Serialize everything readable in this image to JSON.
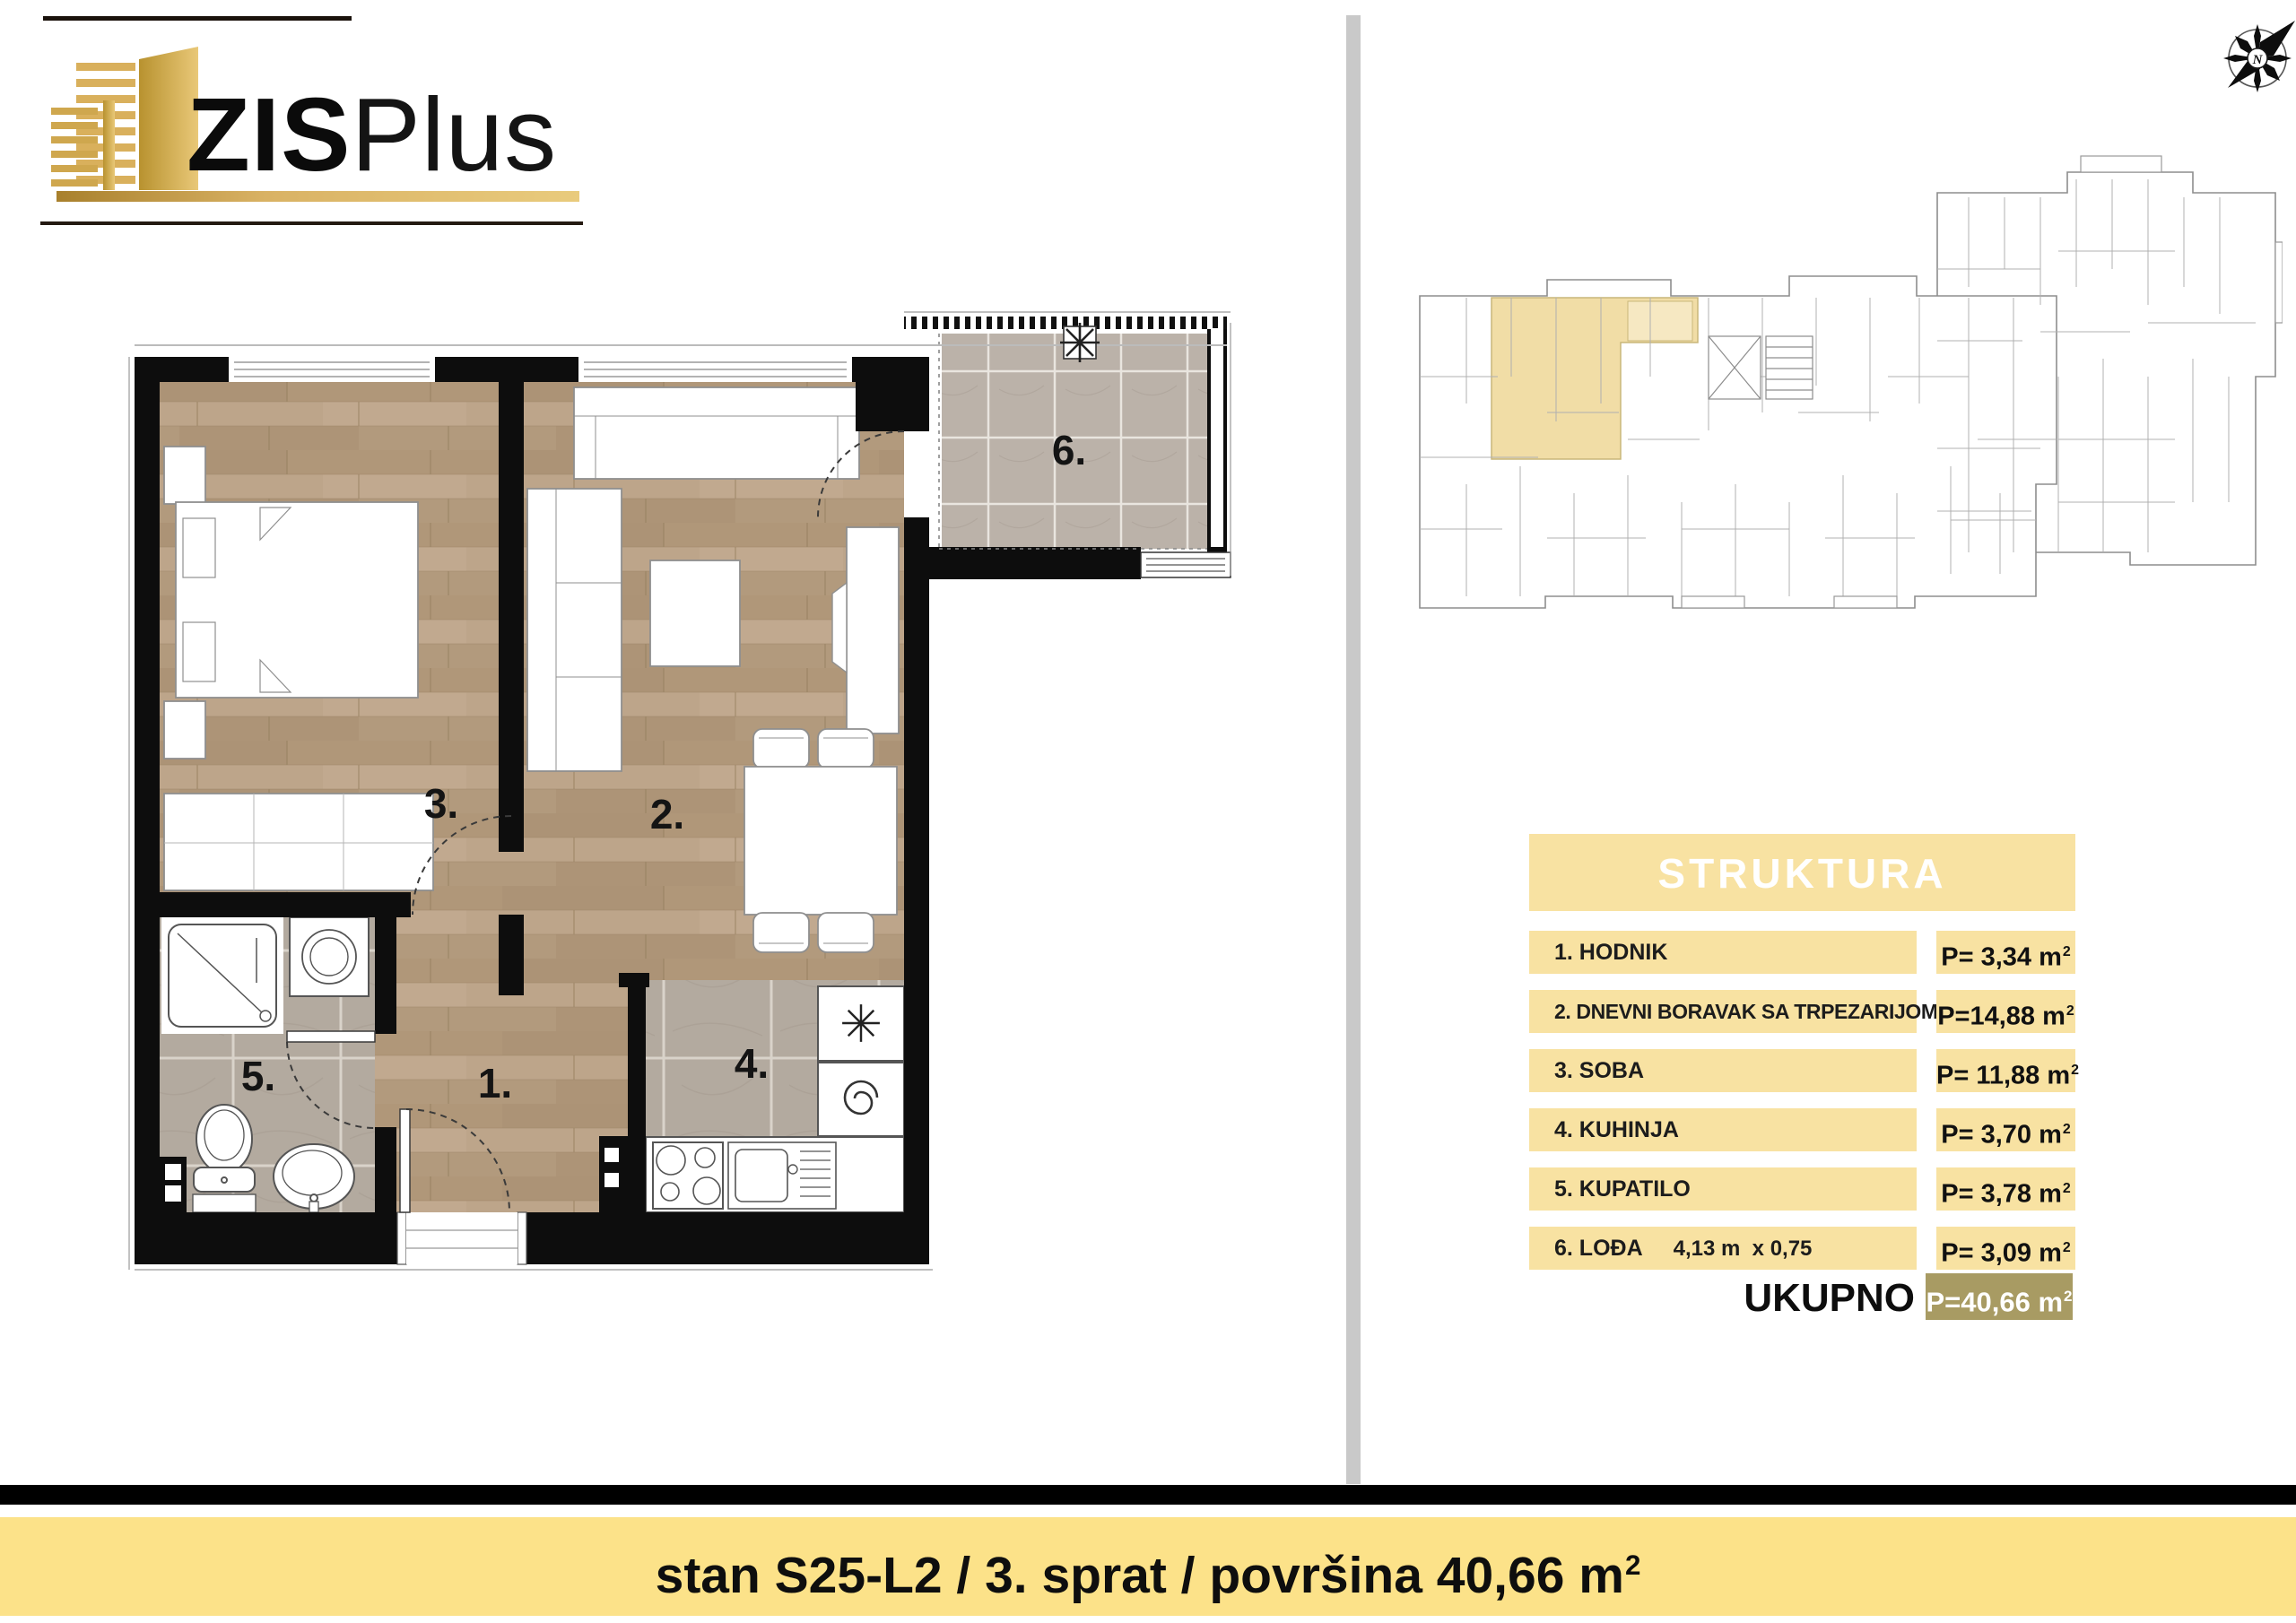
{
  "logo": {
    "zis": "ZIS",
    "plus": "Plus"
  },
  "compass": {
    "letter": "N"
  },
  "floorplan": {
    "labels": {
      "hallway": "1.",
      "living": "2.",
      "bedroom": "3.",
      "kitchen": "4.",
      "bathroom": "5.",
      "loggia": "6."
    }
  },
  "struktura": {
    "title": "STRUKTURA",
    "rows": [
      {
        "label": "1. HODNIK",
        "value": "P= 3,34 m",
        "sup": "2"
      },
      {
        "label": "2. DNEVNI BORAVAK SA TRPEZARIJOM",
        "value": "P=14,88 m",
        "sup": "2"
      },
      {
        "label": "3. SOBA",
        "value": "P= 11,88 m",
        "sup": "2"
      },
      {
        "label": "4. KUHINJA",
        "value": "P= 3,70 m",
        "sup": "2"
      },
      {
        "label": "5. KUPATILO",
        "value": "P= 3,78 m",
        "sup": "2"
      },
      {
        "label": "6. LOĐA",
        "dimension": "4,13 m  x 0,75",
        "value": "P= 3,09 m",
        "sup": "2"
      }
    ],
    "total_label": "UKUPNO",
    "total_value": "P=40,66 m",
    "total_sup": "2"
  },
  "banner": {
    "text": "stan S25-L2 / 3. sprat / površina 40,66 m",
    "sup": "2"
  },
  "colors": {
    "gold": "#c9a245",
    "table_yellow": "#f8e2a2",
    "banner_yellow": "#fce289",
    "total_tan": "#a89b63",
    "wall_black": "#0d0d0d",
    "wood_floor": "#b69e82",
    "tile_gray": "#b3aa9f",
    "highlight_unit": "#f1dda6"
  }
}
